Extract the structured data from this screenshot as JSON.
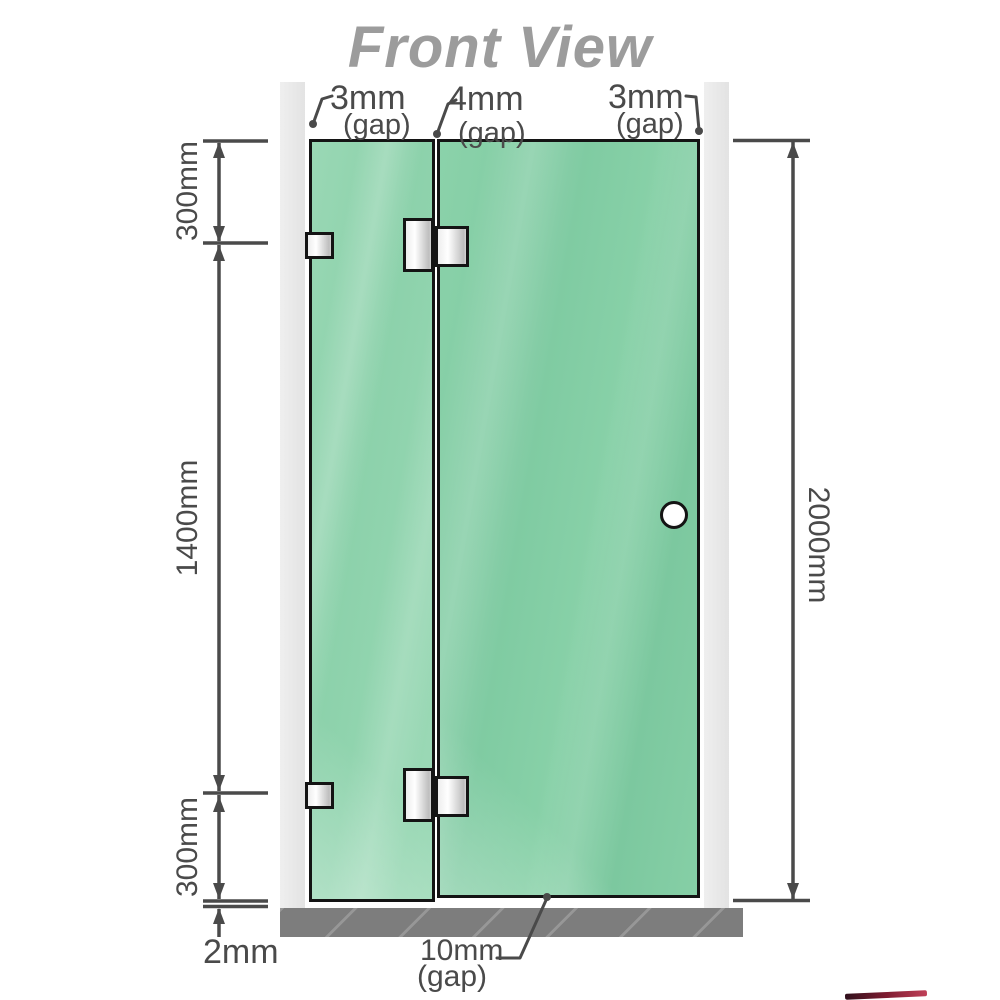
{
  "title": "Front View",
  "labels": {
    "gap_top_left": {
      "value": "3mm",
      "suffix": "(gap)"
    },
    "gap_top_middle": {
      "value": "4mm",
      "suffix": "(gap)"
    },
    "gap_top_right": {
      "value": "3mm",
      "suffix": "(gap)"
    },
    "gap_bottom": {
      "value": "10mm",
      "suffix": "(gap)"
    }
  },
  "dimensions": {
    "left_top": "300mm",
    "left_middle": "1400mm",
    "left_bottom": "300mm",
    "floor_clearance": "2mm",
    "total_height": "2000mm"
  },
  "colors": {
    "glass_fixed_panel": "#8fd3ae",
    "glass_door": "#84cfa6",
    "wall": "#e9e9e9",
    "floor": "#7d7d7d",
    "dimension_lines": "#4a4a4a",
    "title_text": "#9c9c9c",
    "hardware_outline": "#141414",
    "watermark_red": "#7e1c31"
  },
  "components": {
    "fixed_panel": "fixed glass panel",
    "door_panel": "hinged glass door",
    "door_knob": "round knob",
    "wall_bracket": "glass-to-wall bracket",
    "glass_hinge": "glass-to-glass hinge",
    "wall": "wall post",
    "floor": "floor base"
  }
}
